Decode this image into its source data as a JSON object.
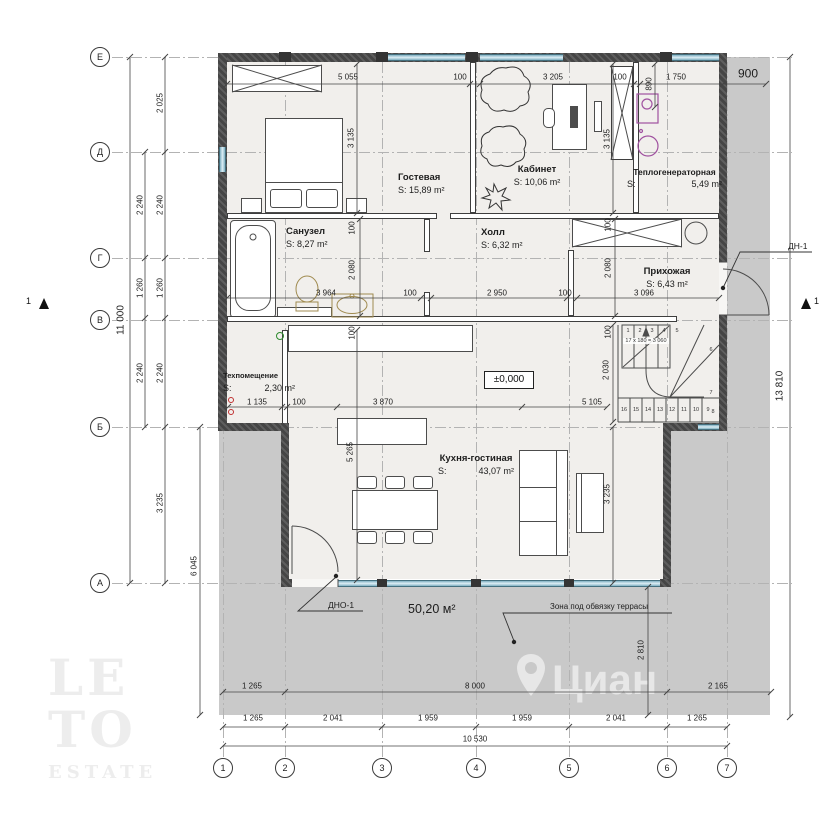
{
  "rooms": [
    {
      "name": "Гостевая",
      "area": "S: 15,89 m²"
    },
    {
      "name": "Кабинет",
      "area": "S: 10,06 m²"
    },
    {
      "name": "Теплогенераторная",
      "area_label": "S:",
      "area_value": "5,49 m²"
    },
    {
      "name": "Санузел",
      "area": "S: 8,27 m²"
    },
    {
      "name": "Холл",
      "area": "S: 6,32 m²"
    },
    {
      "name": "Прихожая",
      "area": "S: 6,43 m²"
    },
    {
      "name": "Техпомещение",
      "area_label": "S:",
      "area_value": "2,30 m²"
    },
    {
      "name": "Кухня-гостиная",
      "area_label": "S:",
      "area_value": "43,07 m²"
    }
  ],
  "labels": {
    "level_mark": "±0,000",
    "terrace_area": "50,20 м²",
    "terrace_zone": "Зона под обвязку террасы",
    "door_terrace": "ДНО-1",
    "door_entry": "ДН-1",
    "section_left": "1",
    "section_right": "1",
    "stair_formula": "17 х 180 = 3 060"
  },
  "grid": {
    "rows": [
      {
        "label": "Е",
        "y": 57
      },
      {
        "label": "Д",
        "y": 152
      },
      {
        "label": "Г",
        "y": 258
      },
      {
        "label": "В",
        "y": 320
      },
      {
        "label": "Б",
        "y": 427
      },
      {
        "label": "А",
        "y": 583
      }
    ],
    "cols": [
      {
        "label": "1",
        "x": 223
      },
      {
        "label": "2",
        "x": 285
      },
      {
        "label": "3",
        "x": 382
      },
      {
        "label": "4",
        "x": 476
      },
      {
        "label": "5",
        "x": 569
      },
      {
        "label": "6",
        "x": 667
      },
      {
        "label": "7",
        "x": 727
      }
    ]
  },
  "dims": [
    {
      "t": "5 055",
      "x": 348,
      "y": 77
    },
    {
      "t": "100",
      "x": 460,
      "y": 77
    },
    {
      "t": "3 205",
      "x": 553,
      "y": 77
    },
    {
      "t": "100",
      "x": 620,
      "y": 77
    },
    {
      "t": "1 750",
      "x": 676,
      "y": 77
    },
    {
      "t": "900",
      "x": 748,
      "y": 74,
      "fs": 12
    },
    {
      "t": "2 025",
      "x": 160,
      "y": 103,
      "r": 1
    },
    {
      "t": "2 240",
      "x": 140,
      "y": 205,
      "r": 1
    },
    {
      "t": "2 240",
      "x": 160,
      "y": 205,
      "r": 1
    },
    {
      "t": "1 260",
      "x": 140,
      "y": 288,
      "r": 1
    },
    {
      "t": "1 260",
      "x": 160,
      "y": 288,
      "r": 1
    },
    {
      "t": "2 240",
      "x": 140,
      "y": 373,
      "r": 1
    },
    {
      "t": "2 240",
      "x": 160,
      "y": 373,
      "r": 1
    },
    {
      "t": "3 235",
      "x": 160,
      "y": 503,
      "r": 1
    },
    {
      "t": "11 000",
      "x": 121,
      "y": 320,
      "r": 1,
      "fs": 10
    },
    {
      "t": "6 045",
      "x": 194,
      "y": 566,
      "r": 1
    },
    {
      "t": "3 135",
      "x": 351,
      "y": 138,
      "r": 1
    },
    {
      "t": "3 135",
      "x": 607,
      "y": 139,
      "r": 1
    },
    {
      "t": "890",
      "x": 649,
      "y": 84,
      "r": 1
    },
    {
      "t": "100",
      "x": 352,
      "y": 228,
      "r": 1
    },
    {
      "t": "2 080",
      "x": 352,
      "y": 270,
      "r": 1
    },
    {
      "t": "100",
      "x": 352,
      "y": 333,
      "r": 1
    },
    {
      "t": "100",
      "x": 608,
      "y": 225,
      "r": 1
    },
    {
      "t": "2 080",
      "x": 608,
      "y": 268,
      "r": 1
    },
    {
      "t": "100",
      "x": 608,
      "y": 332,
      "r": 1
    },
    {
      "t": "3 964",
      "x": 326,
      "y": 293
    },
    {
      "t": "100",
      "x": 410,
      "y": 293
    },
    {
      "t": "2 950",
      "x": 497,
      "y": 293
    },
    {
      "t": "100",
      "x": 565,
      "y": 293
    },
    {
      "t": "3 096",
      "x": 644,
      "y": 293
    },
    {
      "t": "2 030",
      "x": 606,
      "y": 370,
      "r": 1
    },
    {
      "t": "5 105",
      "x": 592,
      "y": 402
    },
    {
      "t": "1 135",
      "x": 257,
      "y": 402
    },
    {
      "t": "100",
      "x": 299,
      "y": 402
    },
    {
      "t": "3 870",
      "x": 383,
      "y": 402
    },
    {
      "t": "5 265",
      "x": 350,
      "y": 452,
      "r": 1
    },
    {
      "t": "3 235",
      "x": 607,
      "y": 494,
      "r": 1
    },
    {
      "t": "2 810",
      "x": 641,
      "y": 650,
      "r": 1
    },
    {
      "t": "1 265",
      "x": 252,
      "y": 686
    },
    {
      "t": "8 000",
      "x": 475,
      "y": 686
    },
    {
      "t": "2 165",
      "x": 718,
      "y": 686
    },
    {
      "t": "1 265",
      "x": 253,
      "y": 718
    },
    {
      "t": "2 041",
      "x": 333,
      "y": 718
    },
    {
      "t": "1 959",
      "x": 428,
      "y": 718
    },
    {
      "t": "1 959",
      "x": 522,
      "y": 718
    },
    {
      "t": "2 041",
      "x": 616,
      "y": 718
    },
    {
      "t": "1 265",
      "x": 697,
      "y": 718
    },
    {
      "t": "10 530",
      "x": 475,
      "y": 739
    },
    {
      "t": "13 810",
      "x": 780,
      "y": 386,
      "r": 1,
      "fs": 10
    }
  ],
  "stairs": {
    "upper": [
      "1",
      "2",
      "3",
      "4"
    ],
    "lower": [
      "16",
      "15",
      "14",
      "13",
      "12",
      "11",
      "10",
      "9"
    ],
    "winders": [
      "5",
      "6",
      "7",
      "8"
    ]
  },
  "watermarks": {
    "logo_line1": "LE",
    "logo_line2": "TO",
    "logo_sub": "ESTATE",
    "brand": "Циан"
  },
  "colors": {
    "terrace": "#c9c9c9",
    "floor": "#f1efec",
    "wall": "#4a4a4a",
    "glazing": "#bcd9e4",
    "fixture_accent": "#a052a0",
    "sanitary": "#a08b50",
    "dimension_text": "#1d1d1d"
  }
}
